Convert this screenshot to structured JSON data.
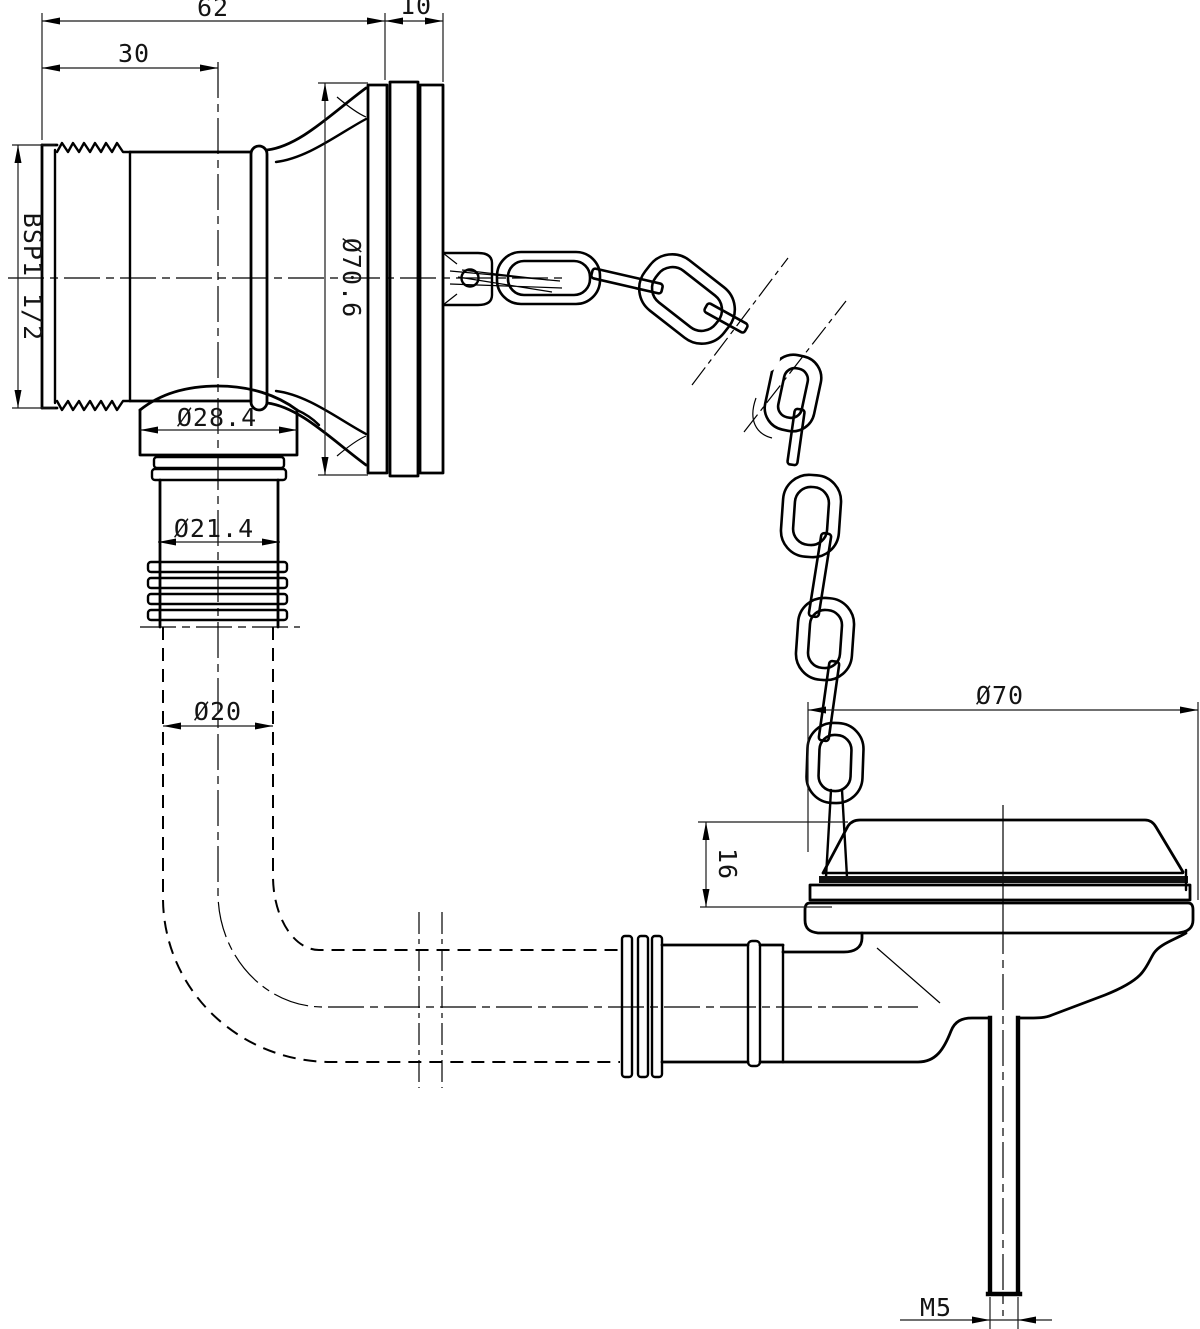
{
  "drawing": {
    "title": "Bath waste with overflow, plug and chain - dimensioned engineering drawing",
    "colors": {
      "line": "#000000",
      "background": "#ffffff"
    },
    "dimensions": {
      "overall_length": {
        "label": "62"
      },
      "flange_thickness": {
        "label": "10"
      },
      "thread_length": {
        "label": "30"
      },
      "thread_size": {
        "label": "BSP1 1/2"
      },
      "overflow_flange_diameter": {
        "label": "Ø70.6"
      },
      "dome_diameter": {
        "label": "Ø28.4"
      },
      "spigot_diameter": {
        "label": "Ø21.4"
      },
      "tube_diameter": {
        "label": "Ø20"
      },
      "plug_diameter": {
        "label": "Ø70"
      },
      "plug_height": {
        "label": "16"
      },
      "rod_thread": {
        "label": "M5"
      }
    }
  }
}
